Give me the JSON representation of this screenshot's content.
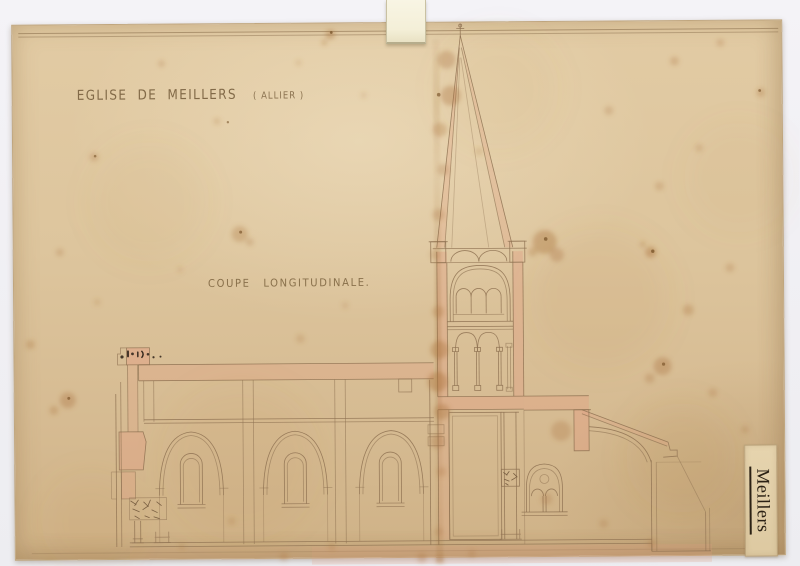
{
  "document": {
    "title_main": "EGLISE DE MEILLERS",
    "title_region": "( ALLIER )",
    "caption": "COUPE LONGITUDINALE.",
    "archive_label": "Meillers"
  },
  "drawing": {
    "subject_description": "Hand-drawn longitudinal section of the church of Meillers: three-bay nave with round-arched windows, crossing bell tower with two arcaded belfry stages and tall spire, choir with two-light traceried window and apse, pink wash on sectioned masonry, on aged foxed paper"
  },
  "colors": {
    "scan_background": "#f1f0f4",
    "paper": "#dcc49d",
    "ink_line": "#8e7151",
    "pink_wash": "#e2a184",
    "stain": "#a9713a",
    "label_paper": "#e3d1ab",
    "label_ink": "#2b2114",
    "tab": "#f6f2dc"
  }
}
